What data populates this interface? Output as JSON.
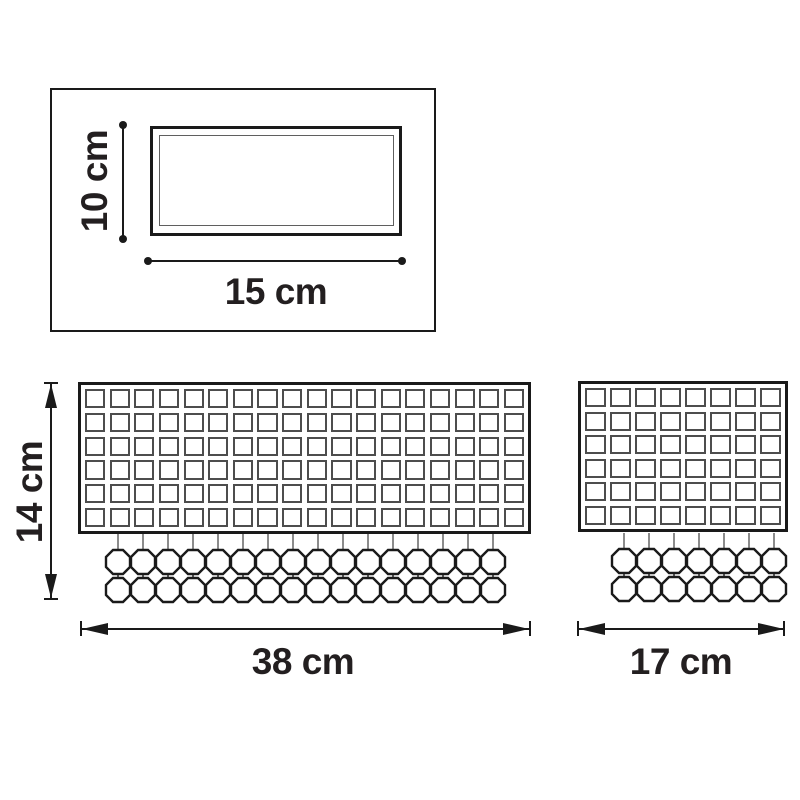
{
  "diagram_type": "wall-lamp dimension drawing",
  "colors": {
    "ink": "#1a1a1a",
    "grid_stroke": "#4d4d4d",
    "strand_stroke": "#666666",
    "background": "#ffffff"
  },
  "views": {
    "top": {
      "height_label": "10 cm",
      "width_label": "15 cm"
    },
    "front_large": {
      "height_label": "14 cm",
      "width_label": "38 cm",
      "grid": {
        "cols": 18,
        "rows": 6
      },
      "strands": {
        "count": 16,
        "beads_per_strand": 2
      }
    },
    "front_small": {
      "width_label": "17 cm",
      "grid": {
        "cols": 8,
        "rows": 6
      },
      "strands": {
        "count": 7,
        "beads_per_strand": 2
      }
    }
  }
}
